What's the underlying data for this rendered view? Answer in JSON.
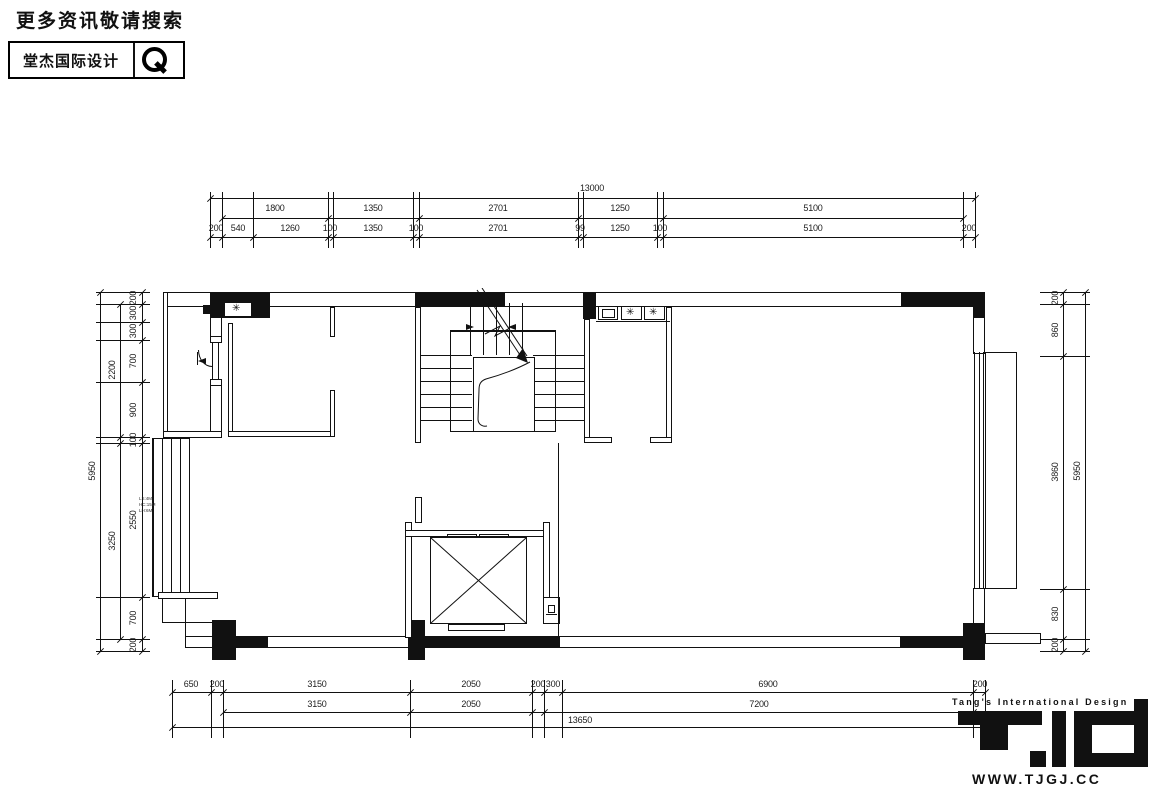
{
  "header": {
    "title": "更多资讯敬请搜索",
    "brand": "堂杰国际设计"
  },
  "footer": {
    "company": "Tang's International Design",
    "website": "WWW.TJGJ.CC"
  },
  "icons": {
    "fan": "✳"
  },
  "plan_note": {
    "l1": "LS:4M",
    "l2": "HC:15M",
    "l3": "LH:6M"
  },
  "dims": {
    "top": {
      "overall": "13000",
      "row2": [
        "1800",
        "1350",
        "2701",
        "1250",
        "5100"
      ],
      "row3": [
        "200",
        "540",
        "1260",
        "100",
        "1350",
        "100",
        "2701",
        "99",
        "1250",
        "100",
        "5100",
        "200"
      ]
    },
    "bottom": {
      "row1": [
        "650",
        "200",
        "3150",
        "2050",
        "200",
        "300",
        "6900",
        "200"
      ],
      "row2": [
        "3150",
        "2050",
        "7200"
      ],
      "overall": "13650"
    },
    "left": {
      "overall": "5950",
      "mid": [
        "2200",
        "3250"
      ],
      "chain": [
        "200",
        "300",
        "300",
        "700",
        "900",
        "100",
        "2550",
        "700",
        "200"
      ]
    },
    "right": {
      "overall": "5950",
      "chain": [
        "200",
        "860",
        "3860",
        "830",
        "200"
      ]
    }
  }
}
